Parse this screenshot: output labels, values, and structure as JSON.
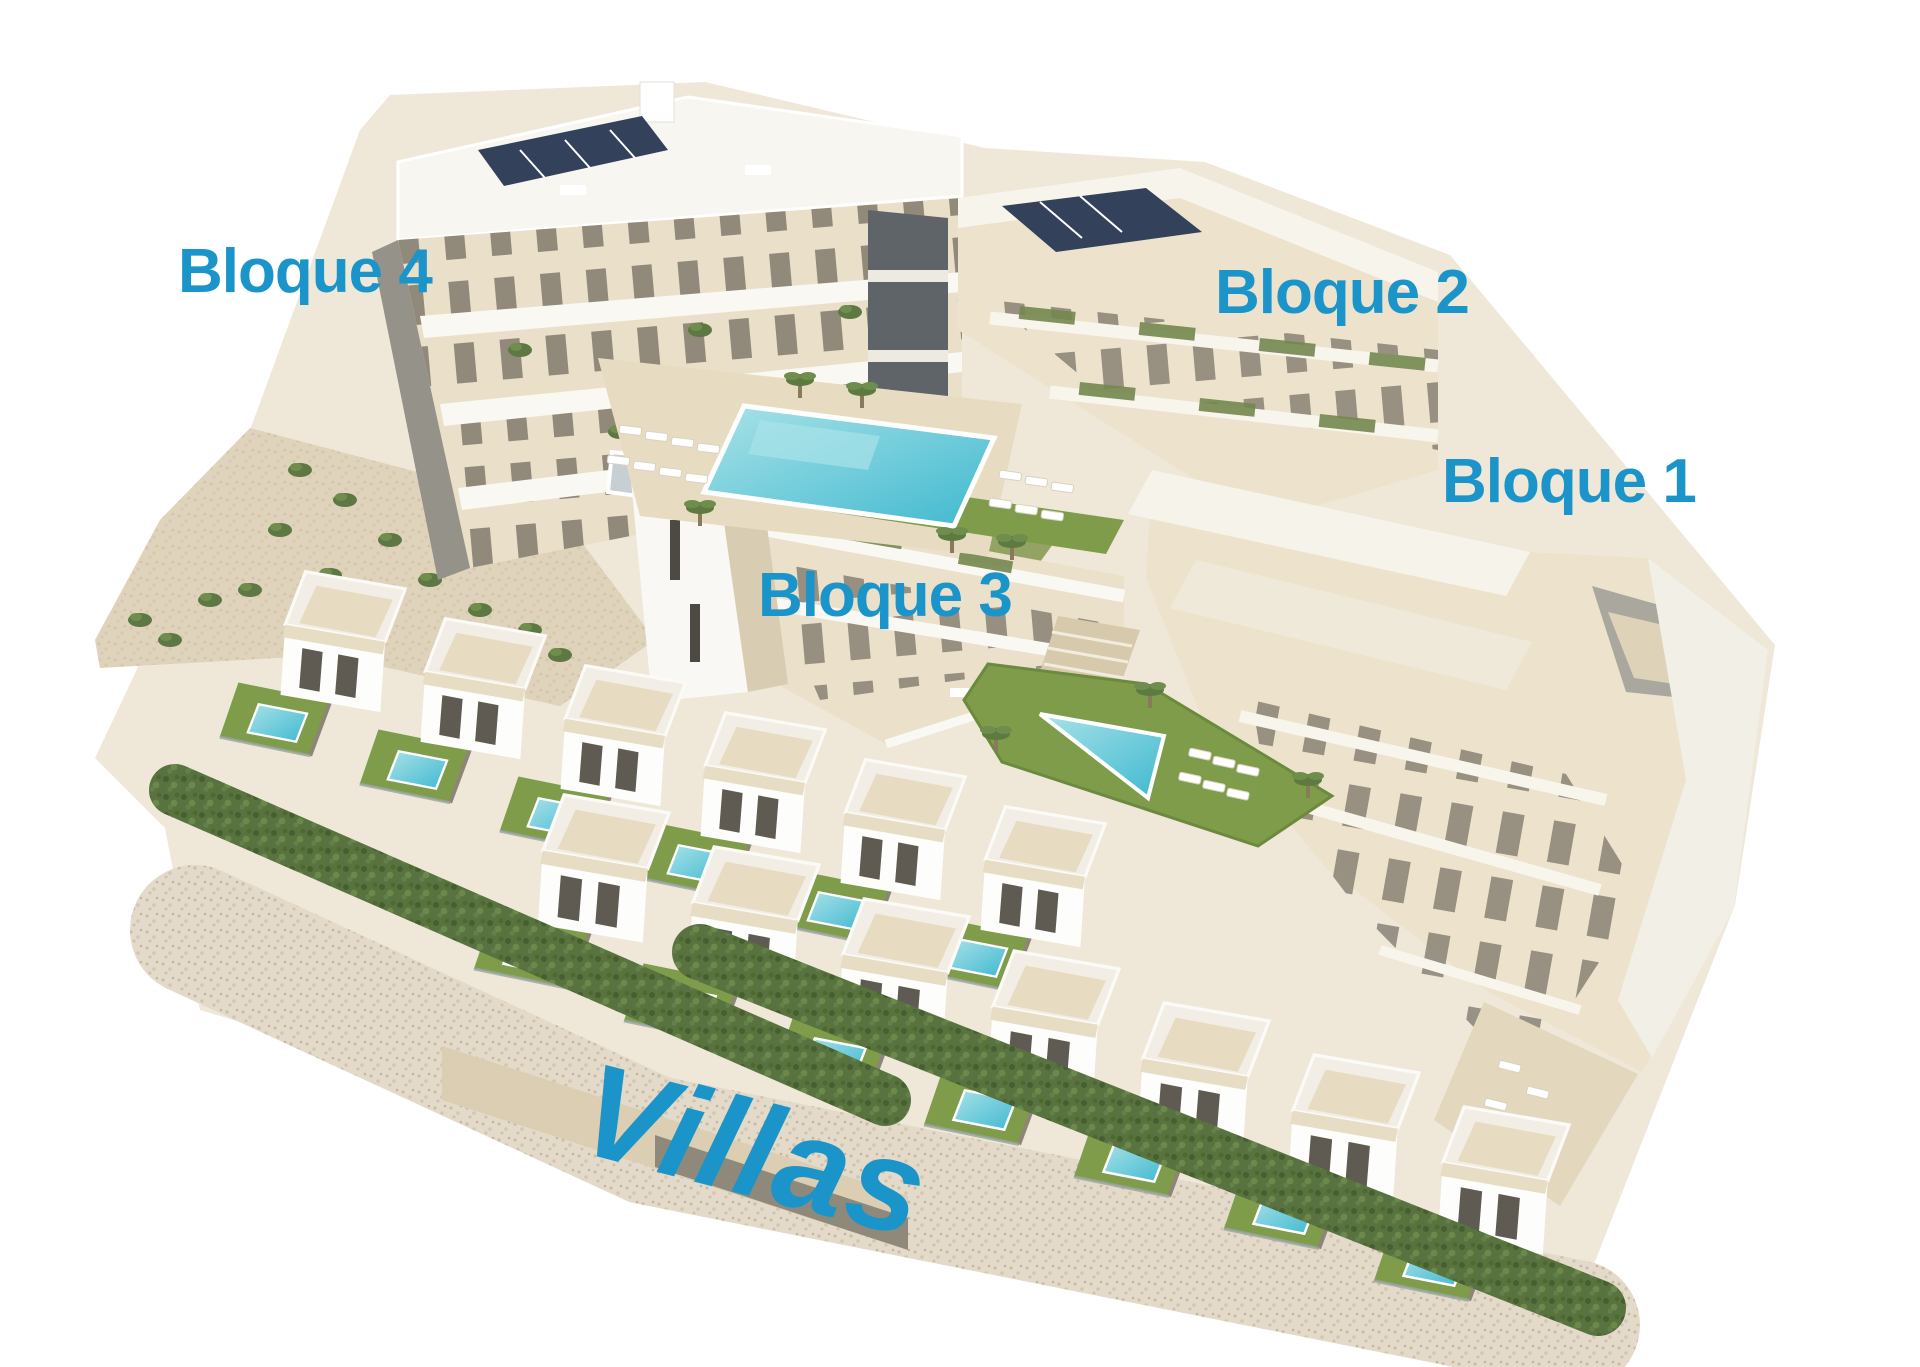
{
  "scene": {
    "type": "architectural-3d-render",
    "description": "Aerial 3D render of a residential development on a white background: four apartment blocks labelled Bloque 1-4, community pools, lawns, hedges and two rows of terraced villas with private pools.",
    "background": "#FFFFFF"
  },
  "labels": {
    "bloque1": "Bloque 1",
    "bloque2": "Bloque 2",
    "bloque3": "Bloque 3",
    "bloque4": "Bloque 4",
    "villas": "Villas"
  },
  "colors": {
    "label_blue": "#1B95C9",
    "facade_cream": "#EADFC8",
    "wall_white": "#F7F4EC",
    "pool_turquoise": "#3FB9CF",
    "lawn_green": "#7E9C49",
    "hedge_green": "#587340",
    "stone_beige": "#E4DACA",
    "solar_panel_navy": "#33415A"
  }
}
